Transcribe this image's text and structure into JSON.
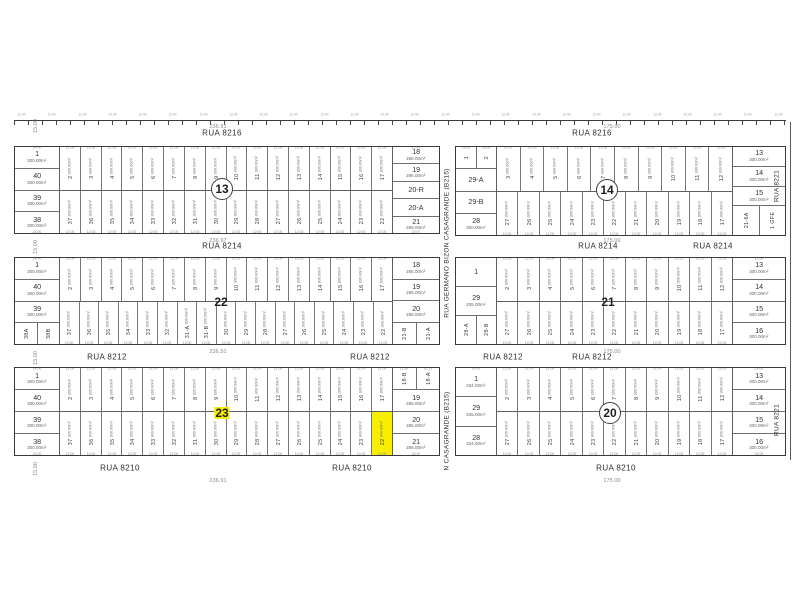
{
  "colors": {
    "highlight": "#f8ee00",
    "line": "#3a3a3a",
    "dim": "#8a8a8a",
    "text": "#333333"
  },
  "map": {
    "top_line": {
      "x": 14,
      "y": 120,
      "w": 772,
      "tick_label": "12.00",
      "count": 26
    },
    "lines": [
      {
        "type": "v",
        "x": 790,
        "y": 122,
        "len": 338
      }
    ],
    "streets": {
      "horizontal": [
        {
          "text": "RUA 8216",
          "x": 222,
          "y": 133
        },
        {
          "text": "RUA 8216",
          "x": 592,
          "y": 133
        },
        {
          "text": "RUA 8214",
          "x": 222,
          "y": 246
        },
        {
          "text": "RUA 8214",
          "x": 598,
          "y": 246
        },
        {
          "text": "RUA 8214",
          "x": 713,
          "y": 246
        },
        {
          "text": "RUA 8212",
          "x": 107,
          "y": 357
        },
        {
          "text": "RUA 8212",
          "x": 370,
          "y": 357
        },
        {
          "text": "RUA 8212",
          "x": 503,
          "y": 357
        },
        {
          "text": "RUA 8212",
          "x": 592,
          "y": 357
        },
        {
          "text": "RUA 8210",
          "x": 120,
          "y": 468
        },
        {
          "text": "RUA 8210",
          "x": 352,
          "y": 468
        },
        {
          "text": "RUA 8210",
          "x": 616,
          "y": 468
        }
      ],
      "vertical": [
        {
          "text": "RUA GERMANO BIZON CASAGRANDE (B215)",
          "x": 447,
          "y": 243
        },
        {
          "text": "N CASAGRANDE (B215)",
          "x": 447,
          "y": 431
        },
        {
          "text": "RUA 8221",
          "x": 777,
          "y": 186
        },
        {
          "text": "RUA 8221",
          "x": 777,
          "y": 420
        }
      ]
    },
    "dims": [
      {
        "text": "236.91",
        "x": 218,
        "y": 127
      },
      {
        "text": "175.00",
        "x": 612,
        "y": 127
      },
      {
        "text": "236.97",
        "x": 218,
        "y": 241
      },
      {
        "text": "175.00",
        "x": 612,
        "y": 241
      },
      {
        "text": "236.91",
        "x": 218,
        "y": 352
      },
      {
        "text": "175.00",
        "x": 612,
        "y": 352
      },
      {
        "text": "236.91",
        "x": 218,
        "y": 481
      },
      {
        "text": "175.00",
        "x": 612,
        "y": 481
      },
      {
        "text": "15.00",
        "x": 36,
        "y": 126,
        "rot": true
      },
      {
        "text": "15.00",
        "x": 36,
        "y": 247,
        "rot": true
      },
      {
        "text": "15.00",
        "x": 36,
        "y": 358,
        "rot": true
      },
      {
        "text": "15.00",
        "x": 36,
        "y": 469,
        "rot": true
      }
    ],
    "blocks": [
      {
        "id": "13",
        "x": 14,
        "y": 146,
        "w": 426,
        "h": 88,
        "lcw": 44,
        "rcw": 46,
        "area": "300.00m²",
        "wdim": "12.00",
        "label": {
          "x": 222,
          "y": 189,
          "circle": true,
          "hl": false
        },
        "left_col": [
          {
            "n": "1",
            "a": "300.00m²",
            "d": "24.00"
          },
          {
            "n": "40",
            "a": "300.00m²"
          },
          {
            "n": "39",
            "a": "300.00m²"
          },
          {
            "n": "38",
            "a": "300.00m²",
            "d2": "24.00"
          }
        ],
        "top_row": [
          "2",
          "3",
          "4",
          "5",
          "6",
          "7",
          "8",
          "9",
          "10",
          "11",
          "12",
          "13",
          "14",
          "15",
          "16",
          "17"
        ],
        "right_col": [
          {
            "n": "18",
            "a": "286.00m²",
            "d": "22.97"
          },
          {
            "n": "19",
            "a": "286.00m²"
          },
          {
            "n": "20-R"
          },
          {
            "n": "20-A"
          },
          {
            "n": "21",
            "a": "286.00m²",
            "d2": "22.97"
          }
        ],
        "bottom_row": [
          "37",
          "36",
          "35",
          "34",
          "33",
          "32",
          "31",
          "30",
          "29",
          "28",
          "27",
          "26",
          "25",
          "24",
          "23",
          "22"
        ]
      },
      {
        "id": "14",
        "x": 455,
        "y": 146,
        "w": 331,
        "h": 90,
        "lcw": 40,
        "rcw": 52,
        "area": "300.00m²",
        "wdim": "12.00",
        "label": {
          "x": 607,
          "y": 190,
          "circle": true,
          "hl": false
        },
        "left_col": [
          {
            "pair": [
              {
                "n": "1",
                "d": "15.00"
              },
              {
                "n": "2",
                "d": "16.00"
              }
            ]
          },
          {
            "n": "29-A"
          },
          {
            "n": "29-B"
          },
          {
            "n": "28",
            "a": "300.00m²"
          }
        ],
        "top_row": [
          "3",
          "4",
          "5",
          "6",
          "7",
          "8",
          "9",
          "10",
          "11",
          "12"
        ],
        "right_col": [
          {
            "n": "13",
            "a": "300.00m²"
          },
          {
            "n": "14",
            "a": "300.00m²"
          },
          {
            "n": "15",
            "a": "300.00m²"
          },
          {
            "pair": [
              {
                "n": "21-6A"
              },
              {
                "n": "1 GFE"
              }
            ]
          }
        ],
        "bottom_row": [
          "27",
          "26",
          "25",
          "24",
          "23",
          "22",
          "21",
          "20",
          "19",
          "18",
          "17"
        ]
      },
      {
        "id": "22",
        "x": 14,
        "y": 257,
        "w": 426,
        "h": 88,
        "lcw": 44,
        "rcw": 46,
        "area": "300.00m²",
        "wdim": "12.00",
        "label": {
          "x": 221,
          "y": 302,
          "circle": false,
          "hl": false
        },
        "left_col": [
          {
            "n": "1",
            "a": "300.00m²",
            "d": "24.00"
          },
          {
            "n": "40",
            "a": "300.00m²"
          },
          {
            "n": "39",
            "a": "300.00m²"
          },
          {
            "pair": [
              {
                "n": "38A"
              },
              {
                "n": "38B"
              }
            ]
          }
        ],
        "top_row": [
          "2",
          "3",
          "4",
          "5",
          "6",
          "7",
          "8",
          "9",
          "10",
          "11",
          "12",
          "13",
          "14",
          "15",
          "16",
          "17"
        ],
        "right_col": [
          {
            "n": "18",
            "a": "285.00m²"
          },
          {
            "n": "19",
            "a": "286.00m²"
          },
          {
            "n": "20",
            "a": "286.00m²"
          },
          {
            "pair": [
              {
                "n": "21-B"
              },
              {
                "n": "21-A"
              }
            ]
          }
        ],
        "bottom_row": [
          "37",
          "36",
          "35",
          "34",
          "33",
          "32",
          "31-A",
          "31-B",
          "30",
          "29",
          "28",
          "27",
          "26",
          "25",
          "24",
          "23",
          "22"
        ]
      },
      {
        "id": "21",
        "x": 455,
        "y": 257,
        "w": 331,
        "h": 88,
        "lcw": 40,
        "rcw": 52,
        "area": "300.00m²",
        "wdim": "12.00",
        "label": {
          "x": 608,
          "y": 302,
          "circle": false,
          "hl": false
        },
        "left_col": [
          {
            "n": "1"
          },
          {
            "n": "29",
            "a": "335.00m²"
          },
          {
            "pair": [
              {
                "n": "28-A"
              },
              {
                "n": "28-B"
              }
            ]
          }
        ],
        "top_row": [
          "2",
          "3",
          "4",
          "5",
          "6",
          "7",
          "8",
          "9",
          "10",
          "11",
          "12"
        ],
        "right_col": [
          {
            "n": "13",
            "a": "300.00m²",
            "d": "12.50"
          },
          {
            "n": "14",
            "a": "300.00m²"
          },
          {
            "n": "15",
            "a": "300.00m²"
          },
          {
            "n": "16",
            "a": "300.00m²"
          }
        ],
        "bottom_row": [
          "27",
          "26",
          "25",
          "24",
          "23",
          "22",
          "21",
          "20",
          "19",
          "18",
          "17"
        ]
      },
      {
        "id": "23",
        "x": 14,
        "y": 367,
        "w": 426,
        "h": 89,
        "lcw": 44,
        "rcw": 46,
        "area": "300.00m²",
        "wdim": "12.00",
        "label": {
          "x": 222,
          "y": 413,
          "circle": false,
          "hl": true
        },
        "left_col": [
          {
            "n": "1",
            "a": "300.00m²",
            "d": "24.00"
          },
          {
            "n": "40",
            "a": "300.00m²"
          },
          {
            "n": "39",
            "a": "300.00m²"
          },
          {
            "n": "38",
            "a": "300.00m²",
            "d2": "24.00"
          }
        ],
        "top_row": [
          "2",
          "3",
          "4",
          "5",
          "6",
          "7",
          "8",
          "9",
          "10",
          "11",
          "12",
          "13",
          "14",
          "15",
          "16",
          "17"
        ],
        "right_col": [
          {
            "pair": [
              {
                "n": "18-B",
                "d": "11.20"
              },
              {
                "n": "18-A",
                "d": "11.71"
              }
            ]
          },
          {
            "n": "19",
            "a": "286.00m²"
          },
          {
            "n": "20",
            "a": "286.00m²"
          },
          {
            "n": "21",
            "a": "286.00m²",
            "d2": "22.97"
          }
        ],
        "bottom_row": [
          "37",
          "36",
          "35",
          "34",
          "33",
          "32",
          "31",
          "30",
          "29",
          "28",
          "27",
          "26",
          "25",
          "24",
          "23",
          {
            "n": "22",
            "hl": true
          }
        ]
      },
      {
        "id": "20",
        "x": 455,
        "y": 367,
        "w": 331,
        "h": 89,
        "lcw": 40,
        "rcw": 52,
        "area": "300.00m²",
        "wdim": "12.00",
        "label": {
          "x": 610,
          "y": 413,
          "circle": true,
          "hl": false
        },
        "left_col": [
          {
            "n": "1",
            "a": "334.00m²",
            "d": "20.00"
          },
          {
            "n": "29",
            "a": "335.00m²"
          },
          {
            "n": "28",
            "a": "334.00m²"
          }
        ],
        "top_row": [
          "2",
          "3",
          "4",
          "5",
          "6",
          "7",
          "8",
          "9",
          "10",
          "11",
          "12"
        ],
        "right_col": [
          {
            "n": "13",
            "a": "300.00m²",
            "d": "24.00"
          },
          {
            "n": "14",
            "a": "300.00m²"
          },
          {
            "n": "15",
            "a": "300.00m²"
          },
          {
            "n": "16",
            "a": "300.00m²",
            "d2": "24.00"
          }
        ],
        "bottom_row": [
          "27",
          "26",
          "25",
          "24",
          "23",
          "22",
          "21",
          "20",
          "19",
          "18",
          "17"
        ]
      }
    ]
  }
}
